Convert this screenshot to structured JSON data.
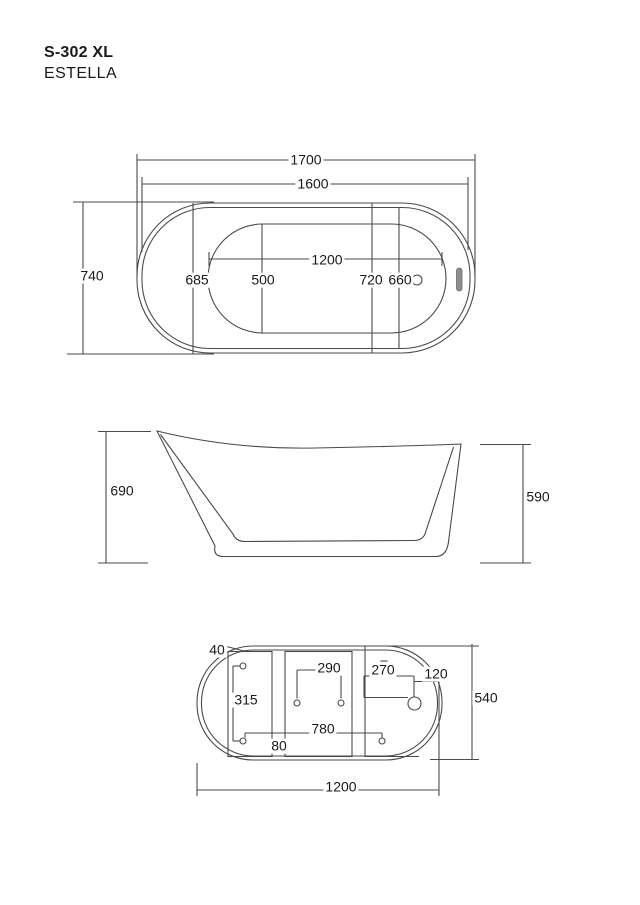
{
  "header": {
    "model": "S-302 XL",
    "product_name": "ESTELLA"
  },
  "colors": {
    "line": "#4a4a4a",
    "text": "#1a1a1a",
    "overflow_fill": "#8f8f8f"
  },
  "views": {
    "top": {
      "label": "top-view",
      "dims": {
        "overall_length": "1700",
        "rim_length": "1600",
        "overall_width": "740",
        "basin_length": "1200",
        "back_offset": "685",
        "seat_width": "500",
        "drain_a": "720",
        "drain_b": "660"
      }
    },
    "side": {
      "label": "side-view",
      "dims": {
        "back_height": "690",
        "front_height": "590"
      }
    },
    "bottom": {
      "label": "bottom-view",
      "dims": {
        "corner_offset": "40",
        "hole_spacing_v": "315",
        "pad_spacing": "290",
        "drain_offset": "270",
        "drain_to_edge": "120",
        "base_width": "540",
        "hole_spacing_h": "780",
        "gap": "80",
        "base_length": "1200"
      }
    }
  }
}
